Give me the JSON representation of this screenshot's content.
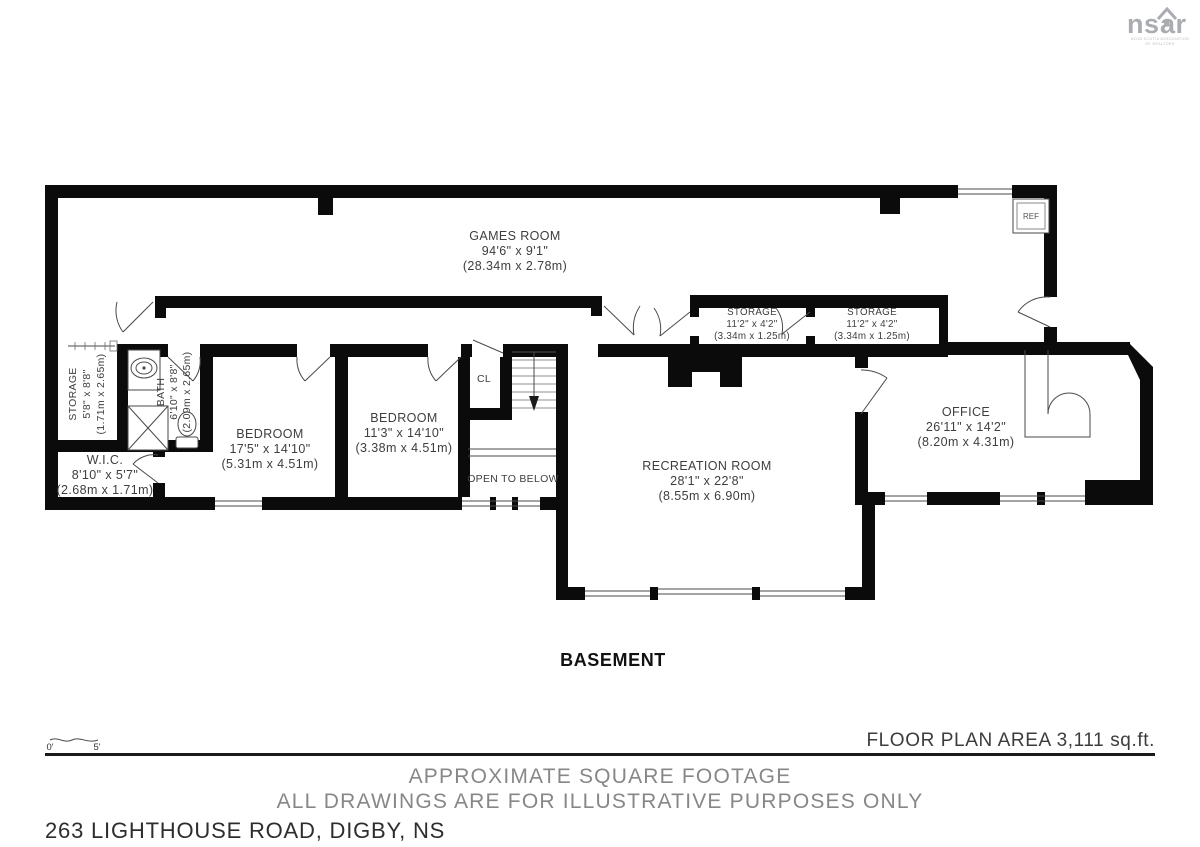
{
  "logo": {
    "brand_left": "ns",
    "brand_right": "ar",
    "tagline_1": "NOVA SCOTIA ASSOCIATION",
    "tagline_2": "OF REALTORS"
  },
  "plan": {
    "level": "BASEMENT",
    "area": "FLOOR PLAN AREA 3,111 sq.ft.",
    "scale": {
      "zero": "0'",
      "five": "5'"
    },
    "rooms": {
      "games": {
        "name": "GAMES ROOM",
        "imperial": "94'6\" x 9'1\"",
        "metric": "(28.34m x 2.78m)"
      },
      "storage_a": {
        "name": "STORAGE",
        "imperial": "11'2\" x 4'2\"",
        "metric": "(3.34m x 1.25m)"
      },
      "storage_b": {
        "name": "STORAGE",
        "imperial": "11'2\" x 4'2\"",
        "metric": "(3.34m x 1.25m)"
      },
      "storage_l": {
        "name": "STORAGE",
        "imperial": "5'8\" x 8'8\"",
        "metric": "(1.71m x 2.65m)"
      },
      "bath": {
        "name": "BATH",
        "imperial": "6'10\" x 8'8\"",
        "metric": "(2.09m x 2.65m)"
      },
      "wic": {
        "name": "W.I.C.",
        "imperial": "8'10\" x 5'7\"",
        "metric": "(2.68m x 1.71m)"
      },
      "bedroom_1": {
        "name": "BEDROOM",
        "imperial": "17'5\" x 14'10\"",
        "metric": "(5.31m x 4.51m)"
      },
      "bedroom_2": {
        "name": "BEDROOM",
        "imperial": "11'3\" x 14'10\"",
        "metric": "(3.38m x 4.51m)"
      },
      "recreation": {
        "name": "RECREATION ROOM",
        "imperial": "28'1\" x 22'8\"",
        "metric": "(8.55m x 6.90m)"
      },
      "office": {
        "name": "OFFICE",
        "imperial": "26'11\" x 14'2\"",
        "metric": "(8.20m x 4.31m)"
      }
    },
    "labels": {
      "closet": "CL",
      "open_below": "OPEN TO BELOW",
      "fridge": "REF"
    }
  },
  "footer": {
    "line1": "APPROXIMATE SQUARE FOOTAGE",
    "line2": "ALL DRAWINGS ARE FOR ILLUSTRATIVE PURPOSES ONLY",
    "address": "263 LIGHTHOUSE ROAD, DIGBY, NS"
  }
}
